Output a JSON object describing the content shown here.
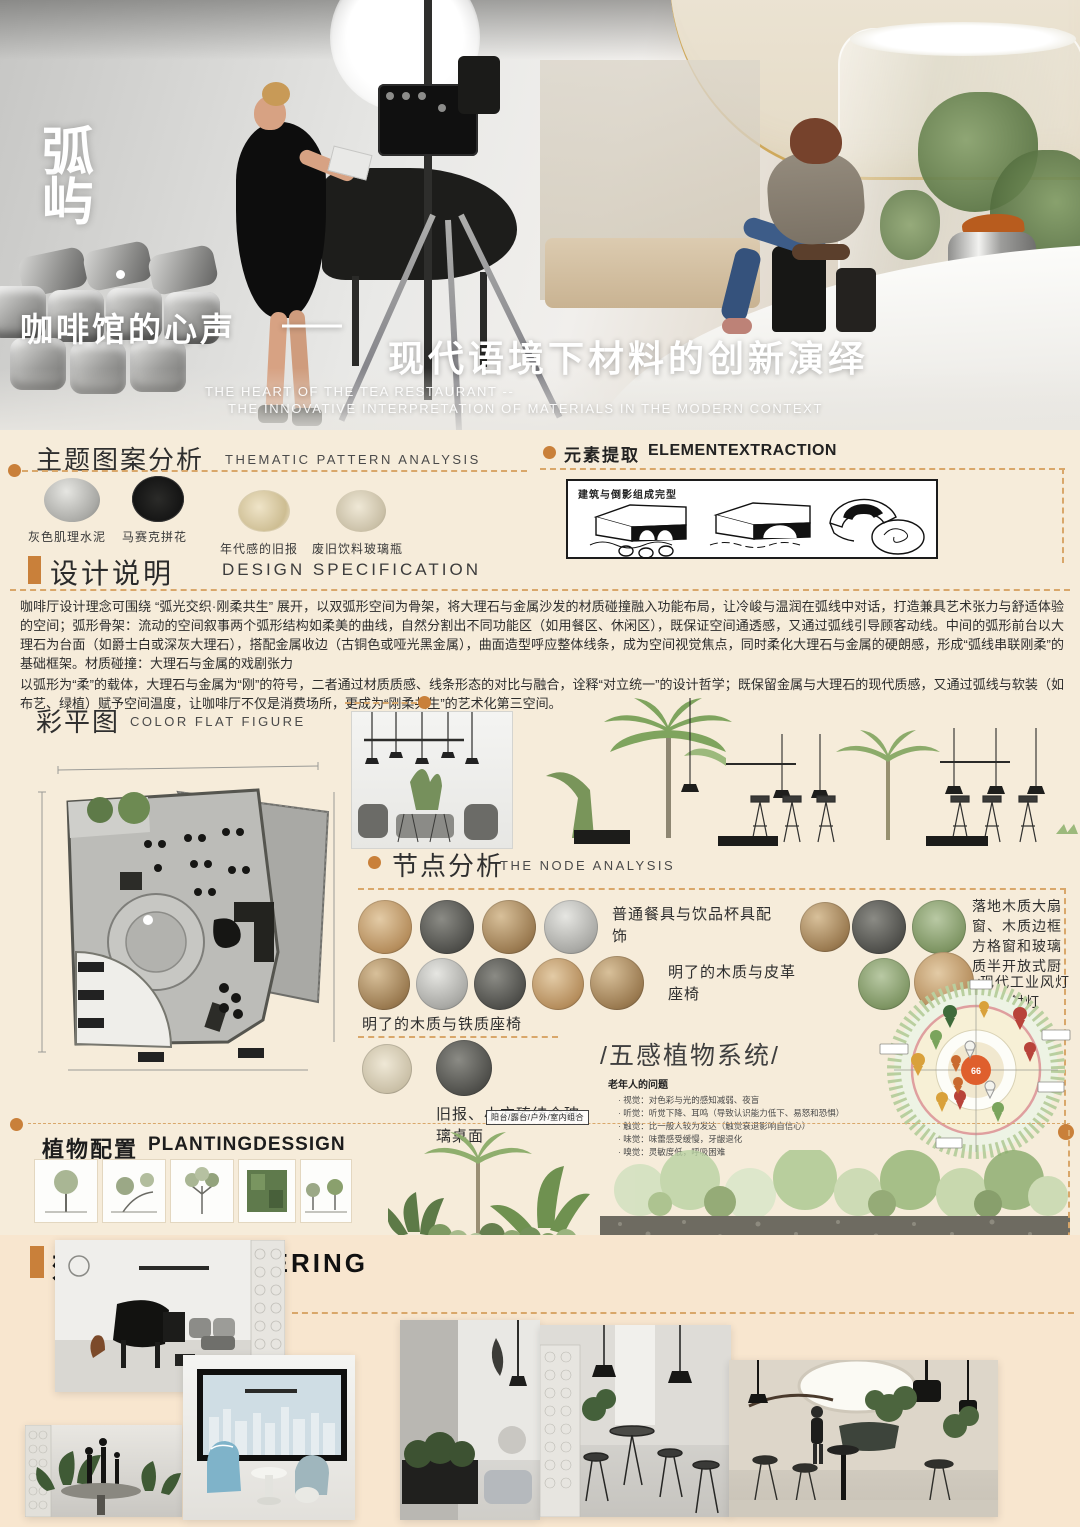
{
  "hero": {
    "logo_top": "弧",
    "logo_bottom": "屿",
    "title_cn": "咖啡馆的心声",
    "title_dash": "——",
    "title_cn2": "现代语境下材料的创新演绎",
    "subtitle_en_1": "THE HEART OF THE TEA RESTAURANT --",
    "subtitle_en_2": "THE INNOVATIVE INTERPRETATION OF MATERIALS IN THE MODERN CONTEXT"
  },
  "thematic": {
    "title_cn": "主题图案分析",
    "title_en": "THEMATIC PATTERN ANALYSIS",
    "swatches": [
      {
        "label": "灰色肌理水泥"
      },
      {
        "label": "马赛克拼花"
      },
      {
        "label": "年代感的旧报"
      },
      {
        "label": "废旧饮料玻璃瓶"
      }
    ]
  },
  "element": {
    "title_cn": "元素提取",
    "title_en": "ELEMENTEXTRACTION",
    "sketch_label": "建筑与倒影组成完型"
  },
  "spec": {
    "title_cn": "设计说明",
    "title_en": "DESIGN SPECIFICATION",
    "p1": "咖啡厅设计理念可围绕 “弧光交织·刚柔共生” 展开，以双弧形空间为骨架，将大理石与金属沙发的材质碰撞融入功能布局，让冷峻与温润在弧线中对话，打造兼具艺术张力与舒适体验的空间；弧形骨架：流动的空间叙事两个弧形结构如柔美的曲线，自然分割出不同功能区（如用餐区、休闲区），既保证空间通透感，又通过弧线引导顾客动线。中间的弧形前台以大理石为台面（如爵士白或深灰大理石），搭配金属收边（古铜色或哑光黑金属），曲面造型呼应整体线条，成为空间视觉焦点，同时柔化大理石与金属的硬朗感，形成“弧线串联刚柔”的基础框架。材质碰撞：大理石与金属的戏剧张力",
    "p2": "以弧形为“柔”的载体，大理石与金属为“刚”的符号，二者通过材质质感、线条形态的对比与融合，诠释“对立统一”的设计哲学；既保留金属与大理石的现代质感，又通过弧线与软装（如布艺、绿植）赋予空间温度，让咖啡厅不仅是消费场所，更成为“刚柔共生”的艺术化第三空间。"
  },
  "flat": {
    "title_cn": "彩平图",
    "title_en": "COLOR FLAT FIGURE"
  },
  "node": {
    "title_cn": "节点分析",
    "title_en": "THE NODE ANALYSIS",
    "label1": "普通餐具与饮品杯具配饰",
    "label2": "落地木质大扇窗、木质边框方格窗和玻璃质半开放式厨房",
    "label3": "明了的木质与皮革座椅",
    "label4": "现代工业风灯具与射灯",
    "label5": "明了的木质与铁质座椅",
    "label6": "旧报、小方砖结合玻璃桌面"
  },
  "senses": {
    "title": "/五感植物系统/",
    "subtitle": "老年人的问题",
    "bullets": [
      "视觉：对色彩与光的感知减弱、夜盲",
      "听觉：听觉下降、耳鸣（导致认识能力低下、易怒和恐惧）",
      "触觉：比一般人较为发达（触觉衰退影响自信心）",
      "味觉：味蕾感受缓慢，牙龈退化",
      "嗅觉：灵敏度低，呼吸困难"
    ],
    "center_label": "66"
  },
  "planting": {
    "title_cn": "植物配置",
    "title_en": "PLANTINGDESSIGN",
    "combo_label": "阳台/露台/户外/室内组合",
    "notes": [
      "1.色彩缤纷的植物，让人看了赏心悦目",
      "2.高大的乔木在风中摇曳，沙沙的声音让人听了很舒服",
      "3.将植物组合形成“可食”的小单元，种植各类草本香草，各色果树的果芒会结合",
      "4.通过芳香树营造记忆与想象从而形成树荫环境",
      "5.茎叶中的油性物质产生，排气湿润系统根部叶片利用组合概念出香气"
    ]
  },
  "rendering": {
    "title_cn": "效果图",
    "title_en": "RENDERING"
  },
  "colors": {
    "accent": "#c9803a",
    "dash": "#d9a76a",
    "cream": "#f6ecda",
    "peach": "#f8e6cf"
  }
}
